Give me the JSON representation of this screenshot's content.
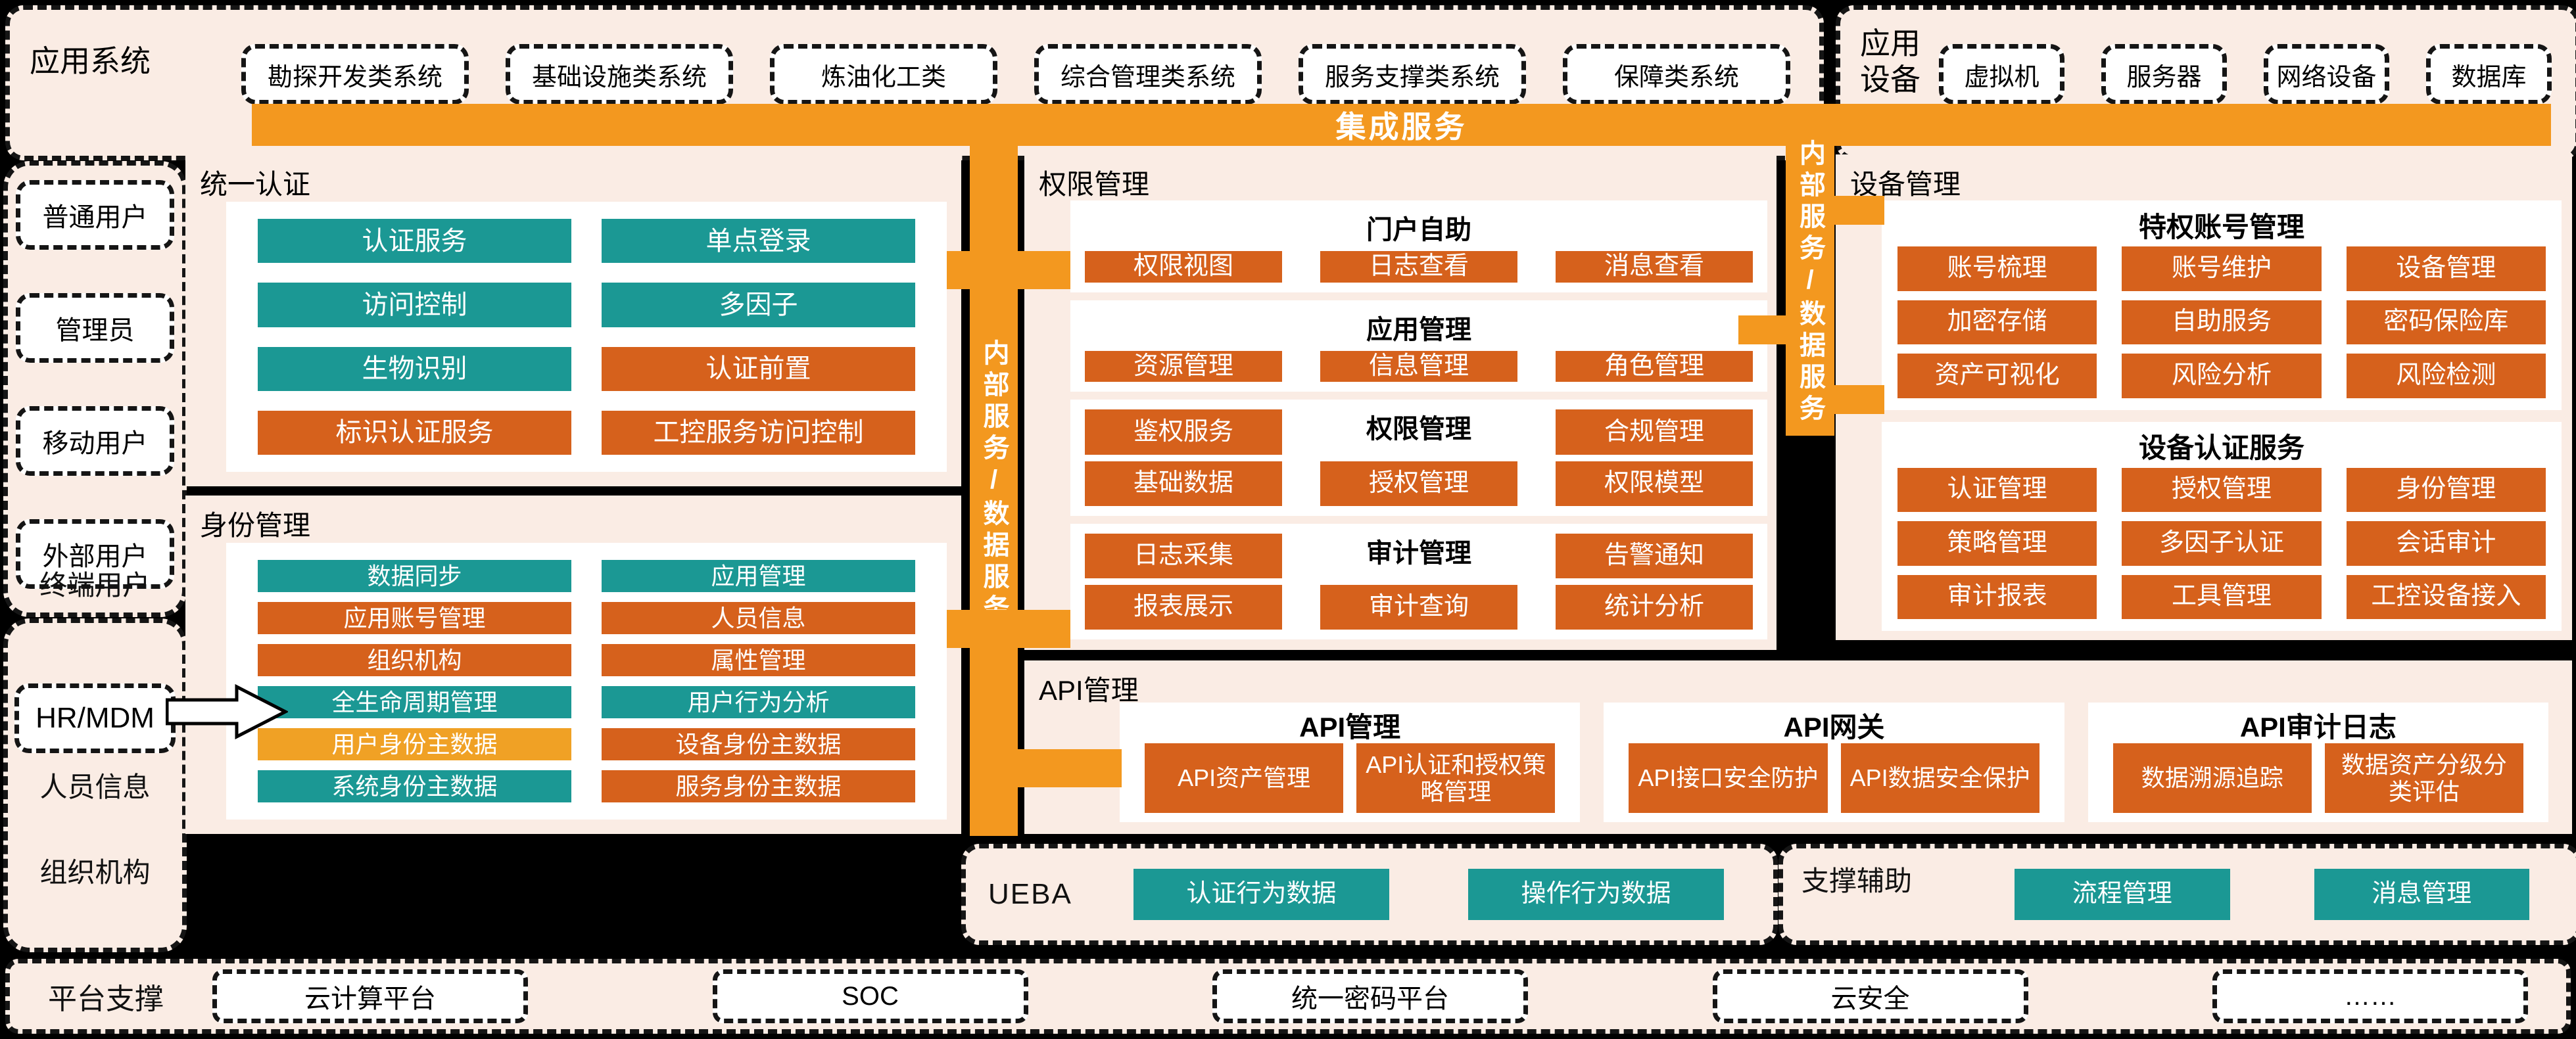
{
  "colors": {
    "cream": "#FAECE4",
    "amber": "#F3981F",
    "orange": "#D6611C",
    "teal": "#1B9894",
    "amber_button": "#F0A125",
    "background": "#000000"
  },
  "top": {
    "app_systems_label": "应用系统",
    "app_systems": [
      "勘探开发类系统",
      "基础设施类系统",
      "炼油化工类",
      "综合管理类系统",
      "服务支撑类系统",
      "保障类系统"
    ],
    "app_devices_label": "应用设备",
    "app_devices": [
      "虚拟机",
      "服务器",
      "网络设备",
      "数据库"
    ],
    "integration_bar": "集成服务"
  },
  "left": {
    "terminal_users": {
      "label": "终端用户",
      "items": [
        "普通用户",
        "管理员",
        "移动用户",
        "外部用户"
      ]
    },
    "hr": {
      "box": "HR/MDM",
      "labels": [
        "人员信息",
        "组织机构"
      ]
    }
  },
  "vertical_bar_label": "内部服务/数据服务",
  "sections": {
    "unified_auth": {
      "title": "统一认证",
      "buttons": [
        {
          "label": "认证服务",
          "color": "teal"
        },
        {
          "label": "单点登录",
          "color": "teal"
        },
        {
          "label": "访问控制",
          "color": "teal"
        },
        {
          "label": "多因子",
          "color": "teal"
        },
        {
          "label": "生物识别",
          "color": "teal"
        },
        {
          "label": "认证前置",
          "color": "orange"
        },
        {
          "label": "标识认证服务",
          "color": "orange"
        },
        {
          "label": "工控服务访问控制",
          "color": "orange"
        }
      ]
    },
    "identity": {
      "title": "身份管理",
      "buttons": [
        {
          "label": "数据同步",
          "color": "teal"
        },
        {
          "label": "应用管理",
          "color": "teal"
        },
        {
          "label": "应用账号管理",
          "color": "orange"
        },
        {
          "label": "人员信息",
          "color": "orange"
        },
        {
          "label": "组织机构",
          "color": "orange"
        },
        {
          "label": "属性管理",
          "color": "orange"
        },
        {
          "label": "全生命周期管理",
          "color": "teal"
        },
        {
          "label": "用户行为分析",
          "color": "teal"
        },
        {
          "label": "用户身份主数据",
          "color": "amber-btn"
        },
        {
          "label": "设备身份主数据",
          "color": "orange"
        },
        {
          "label": "系统身份主数据",
          "color": "teal"
        },
        {
          "label": "服务身份主数据",
          "color": "orange"
        }
      ]
    },
    "permission": {
      "title": "权限管理",
      "panels": [
        {
          "title": "门户自助",
          "layout": "title-top",
          "buttons": [
            "权限视图",
            "日志查看",
            "消息查看"
          ]
        },
        {
          "title": "应用管理",
          "layout": "title-top",
          "buttons": [
            "资源管理",
            "信息管理",
            "角色管理"
          ]
        },
        {
          "title": "权限管理",
          "layout": "title-embedded",
          "buttons": [
            "鉴权服务",
            "合规管理",
            "基础数据",
            "授权管理",
            "权限模型"
          ]
        },
        {
          "title": "审计管理",
          "layout": "title-embedded",
          "buttons": [
            "日志采集",
            "告警通知",
            "报表展示",
            "审计查询",
            "统计分析"
          ]
        }
      ]
    },
    "device": {
      "title": "设备管理",
      "panels": [
        {
          "title": "特权账号管理",
          "buttons": [
            "账号梳理",
            "账号维护",
            "设备管理",
            "加密存储",
            "自助服务",
            "密码保险库",
            "资产可视化",
            "风险分析",
            "风险检测"
          ]
        },
        {
          "title": "设备认证服务",
          "buttons": [
            "认证管理",
            "授权管理",
            "身份管理",
            "策略管理",
            "多因子认证",
            "会话审计",
            "审计报表",
            "工具管理",
            "工控设备接入"
          ]
        }
      ]
    },
    "api": {
      "title": "API管理",
      "panels": [
        {
          "title": "API管理",
          "buttons": [
            "API资产管理",
            "API认证和授权策略管理"
          ]
        },
        {
          "title": "API网关",
          "buttons": [
            "API接口安全防护",
            "API数据安全保护"
          ]
        },
        {
          "title": "API审计日志",
          "buttons": [
            "数据溯源追踪",
            "数据资产分级分类评估"
          ]
        }
      ]
    },
    "ueba": {
      "title": "UEBA",
      "buttons": [
        "认证行为数据",
        "操作行为数据"
      ]
    },
    "support": {
      "title": "支撑辅助",
      "buttons": [
        "流程管理",
        "消息管理"
      ]
    }
  },
  "bottom": {
    "label": "平台支撑",
    "items": [
      "云计算平台",
      "SOC",
      "统一密码平台",
      "云安全",
      "……"
    ]
  }
}
